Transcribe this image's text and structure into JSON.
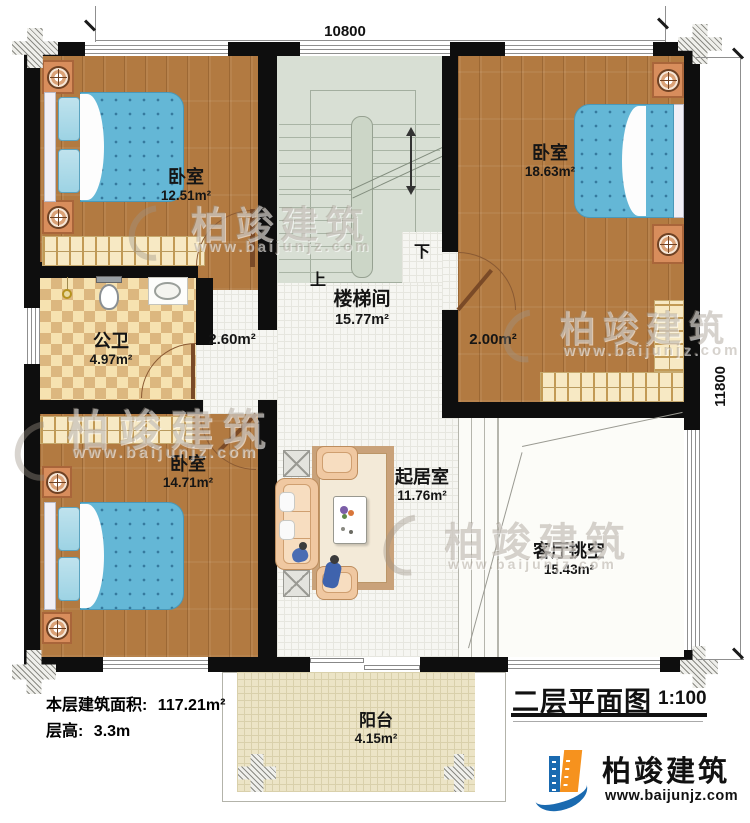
{
  "dimensions": {
    "top": "10800",
    "right": "11800"
  },
  "rooms": {
    "bedroom_tl": {
      "name": "卧室",
      "area": "12.51m²"
    },
    "bedroom_tr": {
      "name": "卧室",
      "area": "18.63m²"
    },
    "bedroom_bl": {
      "name": "卧室",
      "area": "14.71m²"
    },
    "bathroom": {
      "name": "公卫",
      "area": "4.97m²"
    },
    "stairwell": {
      "name": "楼梯间",
      "area": "15.77m²"
    },
    "living": {
      "name": "起居室",
      "area": "11.76m²"
    },
    "void": {
      "name": "客厅挑空",
      "area": "15.43m²"
    },
    "balcony": {
      "name": "阳台",
      "area": "4.15m²"
    }
  },
  "hall": {
    "left_area": "2.60m²",
    "right_area": "2.00m²"
  },
  "stairs": {
    "up_label": "上",
    "down_label": "下"
  },
  "notes": {
    "floor_area_label": "本层建筑面积:",
    "floor_area_value": "117.21m²",
    "floor_height_label": "层高:",
    "floor_height_value": "3.3m"
  },
  "title_block": {
    "title": "二层平面图",
    "scale": "1:100"
  },
  "brand": {
    "name": "柏竣建筑",
    "url": "www.baijunjz.com"
  },
  "colors": {
    "wall": "#0e0e0e",
    "wood": "#b27a41",
    "stair_floor": "#d8dfd4",
    "bed": "#64b7d6",
    "logo_blue": "#1a6ab0",
    "logo_orange": "#f6921e"
  }
}
